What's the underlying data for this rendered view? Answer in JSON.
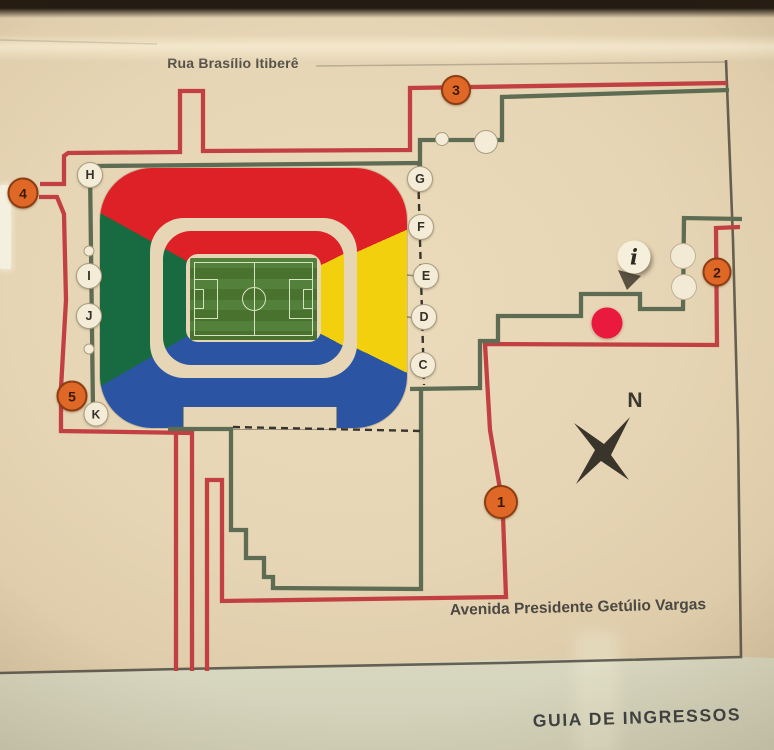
{
  "page": {
    "title": "GUIA DE INGRESSOS"
  },
  "streets": {
    "top": "Rua Brasílio Itiberê",
    "bottom": "Avenida Presidente Getúlio Vargas"
  },
  "compass": {
    "north": "N"
  },
  "info_marker": {
    "symbol": "i"
  },
  "entrances": [
    "1",
    "2",
    "3",
    "4",
    "5"
  ],
  "gates_left": [
    "H",
    "I",
    "J",
    "K"
  ],
  "gates_right": [
    "G",
    "F",
    "E",
    "D",
    "C"
  ],
  "colors": {
    "stand_red": "#de2127",
    "stand_yellow": "#f2d00e",
    "stand_blue": "#2b55a3",
    "stand_green": "#186a40",
    "route_red": "#c24041",
    "route_green": "#5e6c53",
    "dash": "#38352e",
    "entrance_fill": "#df6826",
    "entrance_rim": "#8c3d13",
    "entrance_text": "#3b1b06",
    "marker_red": "#e91a3d",
    "gate_fill": "#f4ecd7",
    "paper": "#e7d6b6",
    "border": "#4f4b42"
  }
}
